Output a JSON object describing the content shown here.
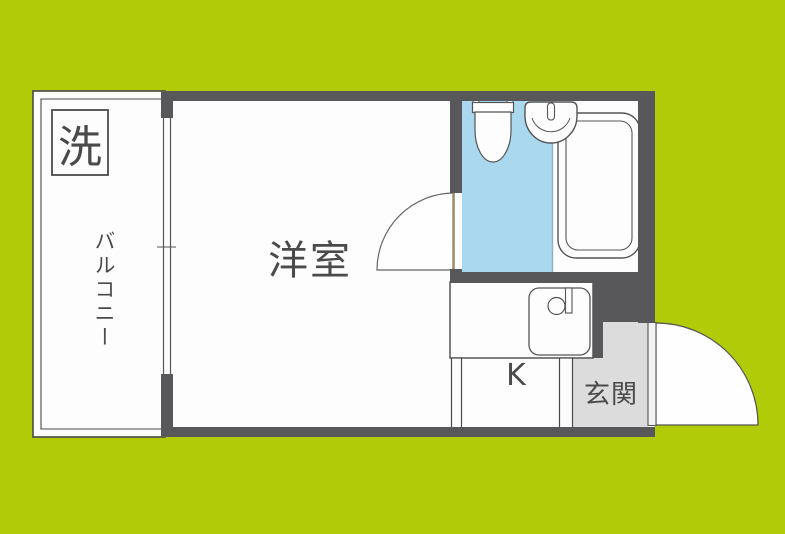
{
  "title": "apartment-floorplan",
  "colors": {
    "background": "#b2cb08",
    "wall": "#58585b",
    "room_floor": "#fdfdfd",
    "toilet_room_floor": "#a9d8ef",
    "entrance_floor": "#dcdcdc",
    "fixture_outline": "#555555",
    "text": "#4a4a4a"
  },
  "rooms": {
    "balcony": {
      "label": "バルコニー"
    },
    "laundry": {
      "label": "洗"
    },
    "western_room": {
      "label": "洋室"
    },
    "kitchen": {
      "label": "K"
    },
    "entrance": {
      "label": "玄関"
    }
  },
  "fixtures": [
    {
      "name": "washing-machine-box"
    },
    {
      "name": "toilet"
    },
    {
      "name": "washbasin"
    },
    {
      "name": "bathtub"
    },
    {
      "name": "kitchen-sink"
    },
    {
      "name": "balcony-window"
    },
    {
      "name": "room-door"
    },
    {
      "name": "entrance-door"
    }
  ]
}
